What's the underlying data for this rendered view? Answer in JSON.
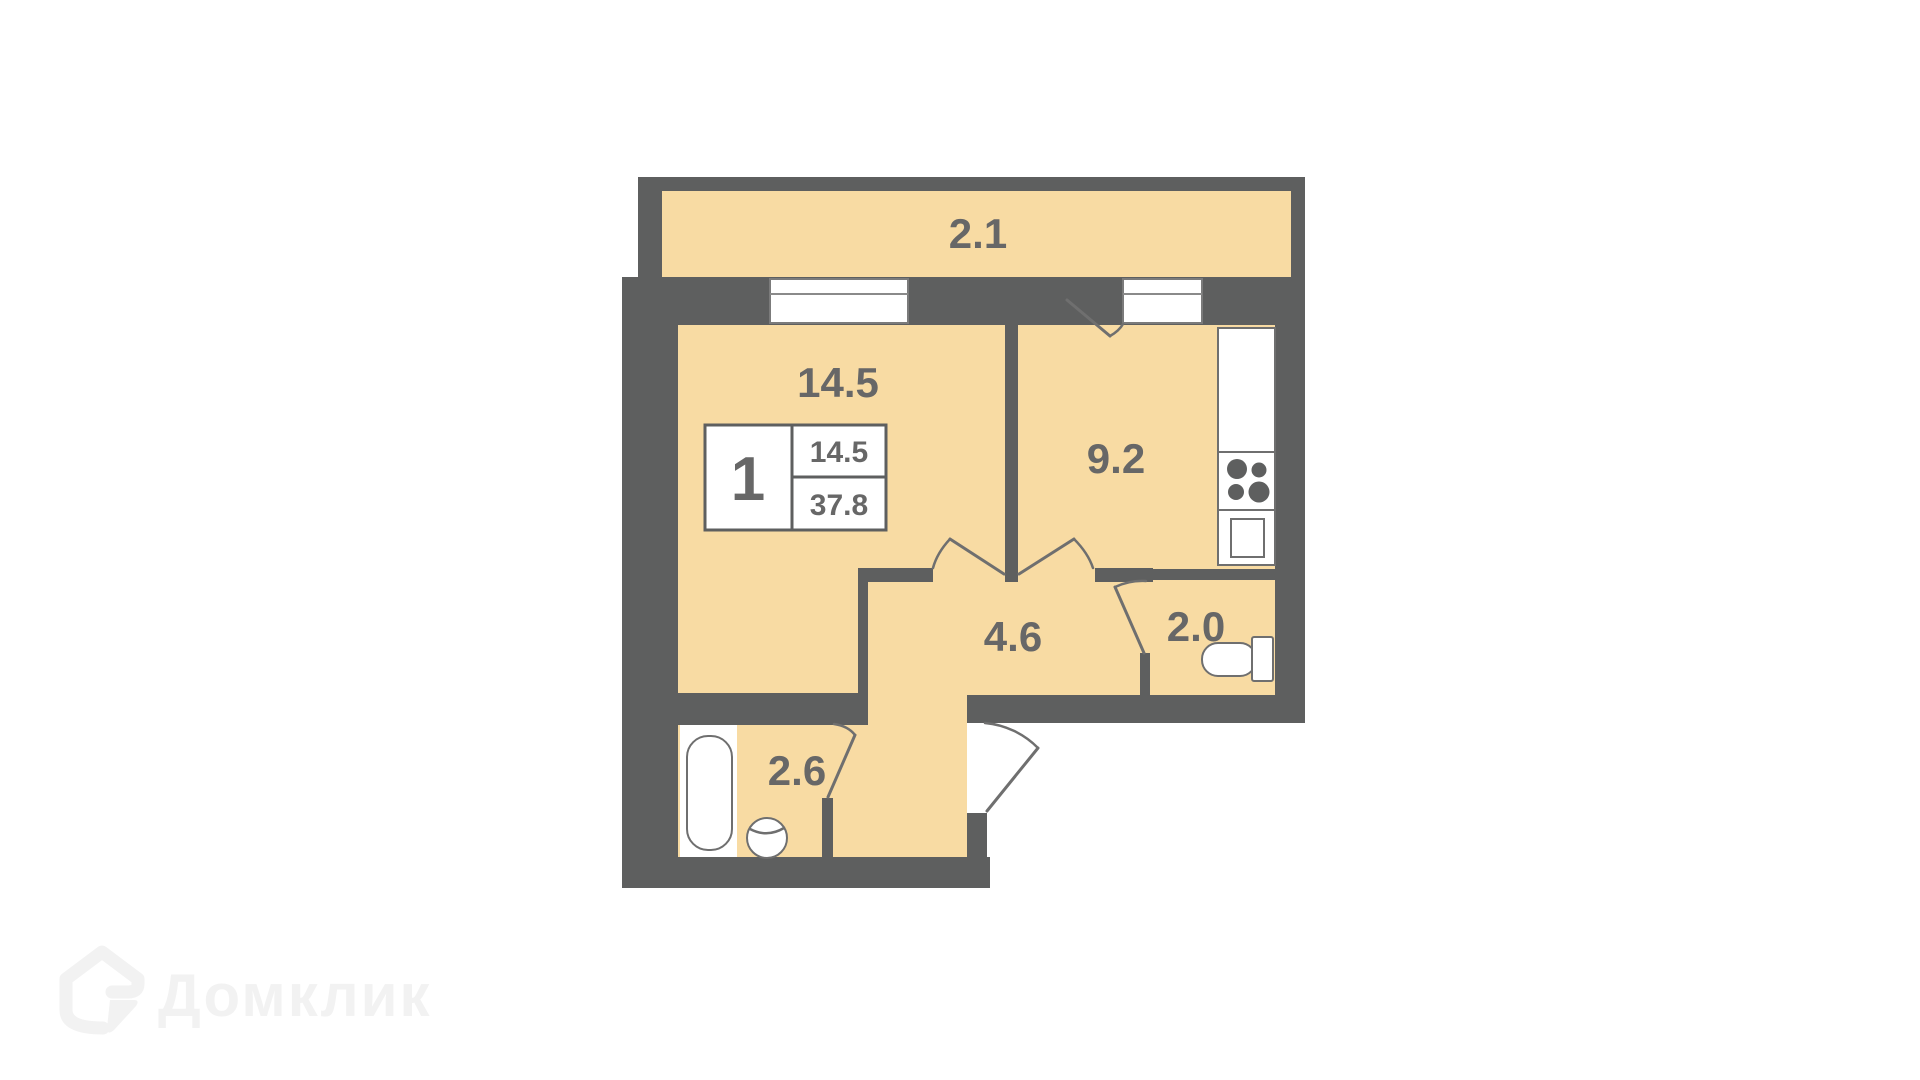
{
  "plan": {
    "rooms": [
      {
        "id": "balcony",
        "label": "2.1"
      },
      {
        "id": "living-room",
        "label": "14.5"
      },
      {
        "id": "kitchen",
        "label": "9.2"
      },
      {
        "id": "hallway",
        "label": "4.6"
      },
      {
        "id": "toilet",
        "label": "2.0"
      },
      {
        "id": "bathroom",
        "label": "2.6"
      }
    ],
    "info_box": {
      "rooms_count": "1",
      "living_area": "14.5",
      "total_area": "37.8"
    },
    "colors": {
      "wall": "#5e5f5f",
      "floor": "#f8dba3",
      "line": "#6f6f6f",
      "label": "#676767",
      "watermark": "#f2f2f2"
    }
  },
  "watermark": {
    "brand": "Домклик"
  }
}
